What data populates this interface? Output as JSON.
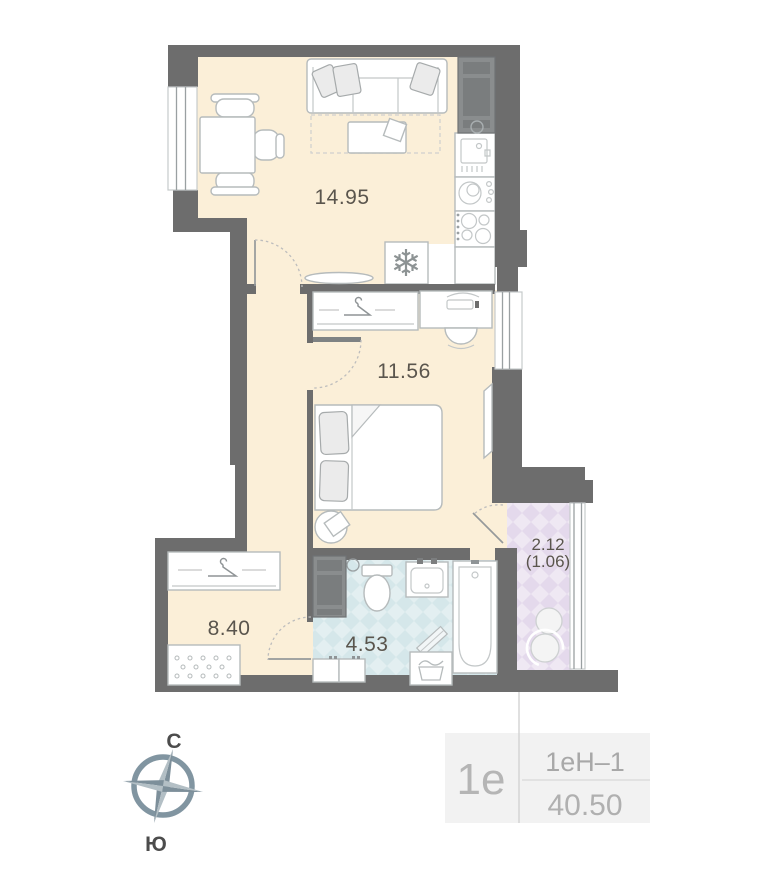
{
  "title": "apartment-floor-plan",
  "rooms": {
    "kitchen_living": {
      "area": "14.95"
    },
    "bedroom": {
      "area": "11.56"
    },
    "hallway": {
      "area": "8.40"
    },
    "bathroom": {
      "area": "4.53"
    },
    "balcony": {
      "area": "2.12",
      "area_with_coefficient": "(1.06)"
    }
  },
  "compass": {
    "north_label": "С",
    "south_label": "Ю"
  },
  "unit_info": {
    "layout_code": "1е",
    "unit_type": "1еН–1",
    "total_area": "40.50"
  },
  "icons": {
    "snowflake": "❄"
  },
  "colors": {
    "wall": "#6d6d6d",
    "floor_main": "#fbefd8",
    "floor_bathroom": "#e3eff1",
    "floor_bathroom_check": "#d5e7ea",
    "floor_balcony": "#efe8f3",
    "floor_balcony_check": "#e4d9ec",
    "compass": "#7d8f9a",
    "room_label_text": "#5a554d",
    "info_text": "#b0b0b0"
  }
}
